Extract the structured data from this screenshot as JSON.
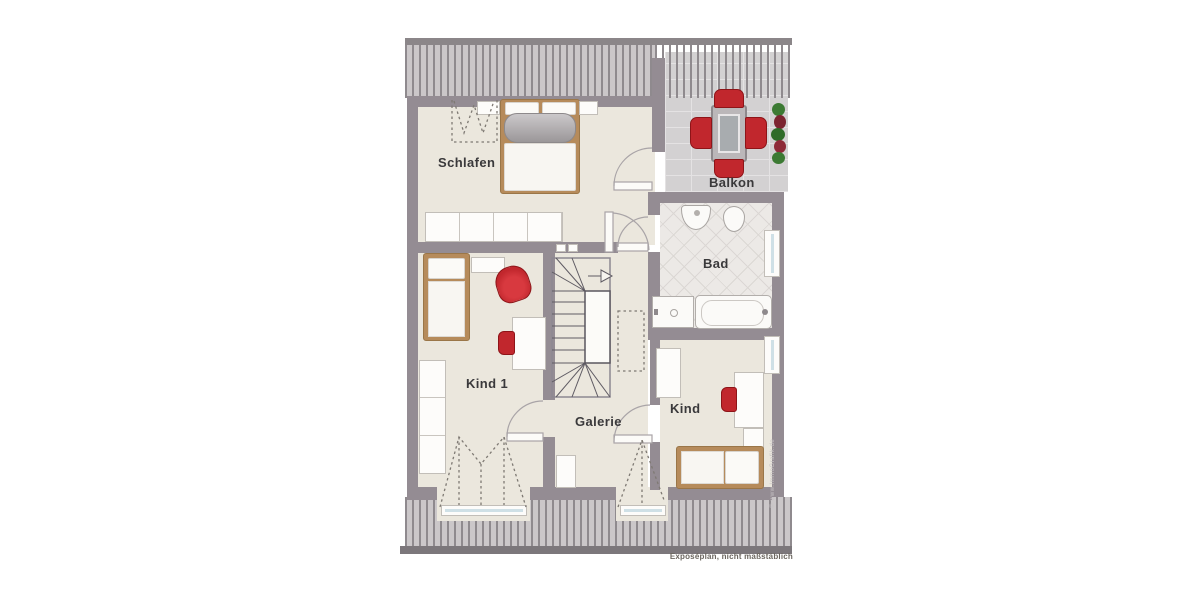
{
  "plan": {
    "rooms": [
      {
        "id": "schlafen",
        "label": "Schlafen"
      },
      {
        "id": "balkon",
        "label": "Balkon"
      },
      {
        "id": "bad",
        "label": "Bad"
      },
      {
        "id": "kind1",
        "label": "Kind 1"
      },
      {
        "id": "galerie",
        "label": "Galerie"
      },
      {
        "id": "kind",
        "label": "Kind"
      }
    ],
    "notes": {
      "footer": "Exposéplan, nicht maßstäblich",
      "watermark": "© www.ImmoGrafik.de"
    },
    "colors": {
      "wall": "#948C93",
      "floor": "#EBE7DD",
      "roof_background": "#CBC7C9",
      "roof_stripe": "#8F8A8E",
      "accent_red": "#C1272D",
      "wood": "#B68B5B",
      "bad_tile": "#ECE9E6",
      "balcony_tile": "#D3D1D2",
      "window_glass": "#D3E2E8"
    },
    "furniture": {
      "schlafen": [
        "double-bed",
        "nightstand-left",
        "nightstand-right",
        "wardrobe",
        "sloped-roof-storage"
      ],
      "balkon": [
        "outdoor-table",
        "chair-top",
        "chair-bottom",
        "chair-left",
        "chair-right",
        "plants"
      ],
      "bad": [
        "sink",
        "toilet",
        "shower",
        "bathtub"
      ],
      "kind1": [
        "single-bed",
        "nightstand",
        "armchair",
        "desk",
        "desk-chair",
        "wardrobe"
      ],
      "kind": [
        "single-bed",
        "desk",
        "desk-chair",
        "wardrobe",
        "shelf"
      ],
      "galerie": [
        "staircase",
        "cabinet"
      ]
    }
  }
}
